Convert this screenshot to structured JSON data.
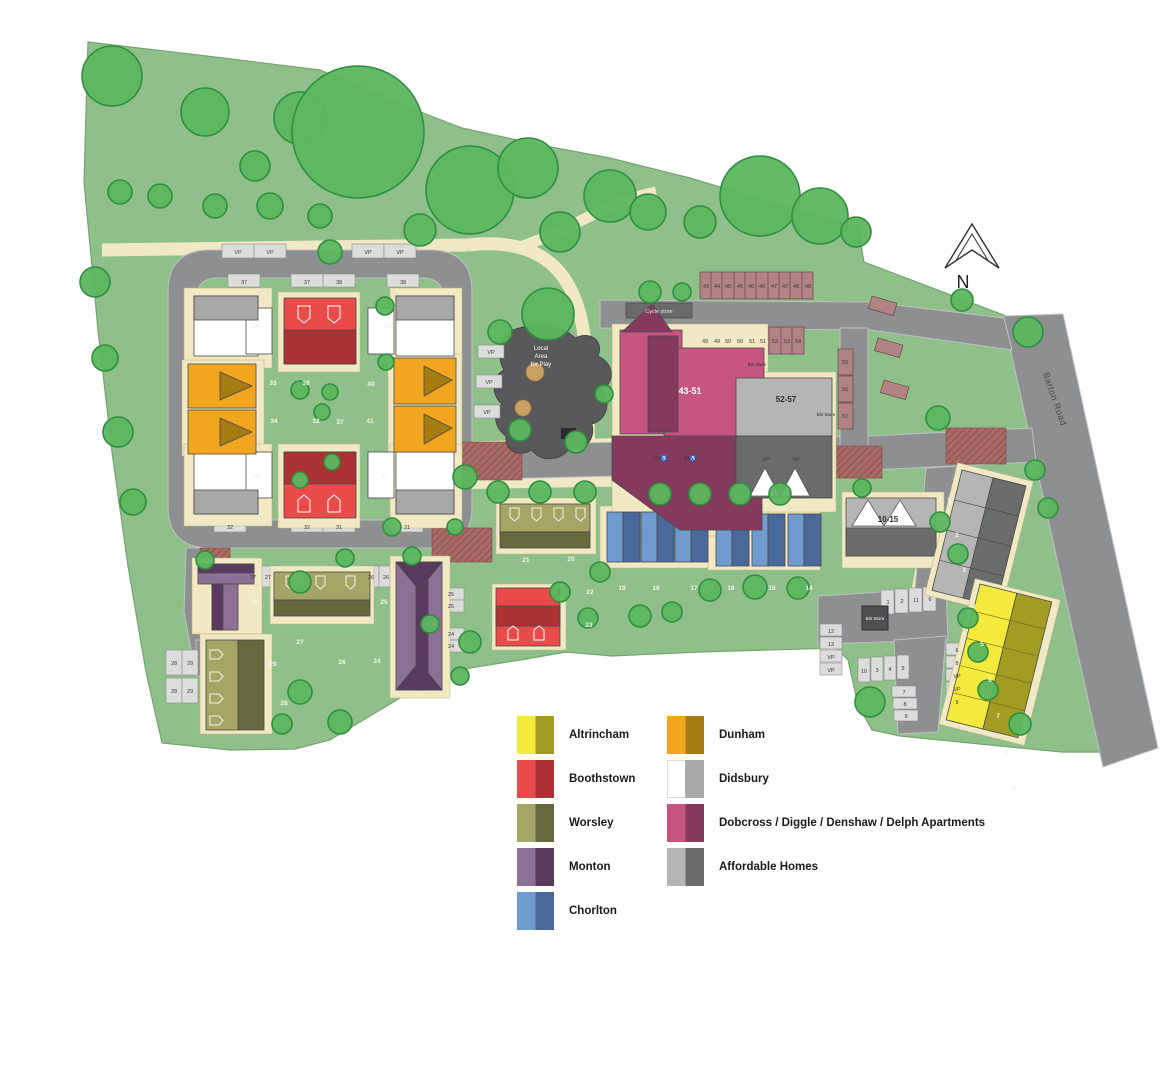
{
  "site_colors": {
    "grass": "#8fc08a",
    "grass_light": "#9cc795",
    "road": "#8d8f91",
    "path": "#f0e9c3",
    "tree": "#5cb65f",
    "play_area": "#58585a",
    "parking_bay_red": "#b28384",
    "junction_red": "#a96a64"
  },
  "legend": {
    "items": [
      {
        "label": "Altrincham",
        "light": "#f3ea3b",
        "dark": "#a29d22"
      },
      {
        "label": "Boothstown",
        "light": "#e84b49",
        "dark": "#ac3132"
      },
      {
        "label": "Worsley",
        "light": "#a5a566",
        "dark": "#66693d"
      },
      {
        "label": "Monton",
        "light": "#8d7095",
        "dark": "#573a5e"
      },
      {
        "label": "Chorlton",
        "light": "#6f9bce",
        "dark": "#49699b"
      },
      {
        "label": "Dunham",
        "light": "#f2a61f",
        "dark": "#a57b12"
      },
      {
        "label": "Didsbury",
        "light": "#ffffff",
        "dark": "#a8a8a8"
      },
      {
        "label": "Dobcross / Diggle / Denshaw / Delph Apartments",
        "light": "#c75582",
        "dark": "#833a5c"
      },
      {
        "label": "Affordable Homes",
        "light": "#b5b5b5",
        "dark": "#6a6c6b"
      }
    ]
  },
  "north": {
    "label": "N"
  },
  "labels": {
    "barton_road": "Barton Road",
    "play_area": [
      "Local",
      "Area",
      "for Play"
    ],
    "cycle_store": "Cycle store",
    "bin_store": "Bin Store",
    "apartments_43_51": "43-51",
    "homes_52_57": "52-57",
    "homes_10_15": "10-15"
  },
  "plots": {
    "loop": [
      "36",
      "39",
      "33",
      "38",
      "40",
      "34",
      "32",
      "37",
      "41",
      "35",
      "42"
    ],
    "south": [
      "21",
      "20",
      "22",
      "23"
    ],
    "chorlton": [
      "19",
      "18",
      "17",
      "16",
      "15",
      "14"
    ],
    "southwest": [
      "30",
      "25",
      "27",
      "29",
      "26",
      "24",
      "28"
    ],
    "east": [
      "1",
      "2",
      "3",
      "4",
      "5",
      "6",
      "7",
      "8",
      "9"
    ]
  },
  "parking": {
    "loop_vp": [
      "VP",
      "VP",
      "VP",
      "VP"
    ],
    "loop_top": [
      "37",
      "37",
      "38",
      "38"
    ],
    "loop_bottom": [
      "32",
      "32",
      "31",
      "31"
    ],
    "row_north": [
      "43",
      "44",
      "45",
      "45",
      "46",
      "46",
      "47",
      "47",
      "48",
      "48"
    ],
    "row_south": [
      "49",
      "49",
      "50",
      "50",
      "51",
      "51",
      "52",
      "53",
      "54"
    ],
    "side": [
      "55",
      "56",
      "57"
    ],
    "spine_vp": [
      "VP",
      "VP"
    ],
    "accessible": [
      "43♿",
      "44♿"
    ],
    "play_vp": [
      "VP",
      "VP",
      "VP"
    ],
    "court_top": [
      "1",
      "2",
      "11",
      "6"
    ],
    "court_left": [
      "12",
      "13",
      "VP",
      "VP"
    ],
    "court_mid": [
      "10",
      "3",
      "4",
      "5"
    ],
    "court_low": [
      "7",
      "8",
      "9"
    ],
    "court_right": [
      "6",
      "8",
      "VP",
      "VP",
      "9"
    ],
    "sw": [
      "27",
      "27",
      "26",
      "26",
      "25",
      "25",
      "24",
      "24",
      "28",
      "29",
      "28",
      "29"
    ]
  }
}
